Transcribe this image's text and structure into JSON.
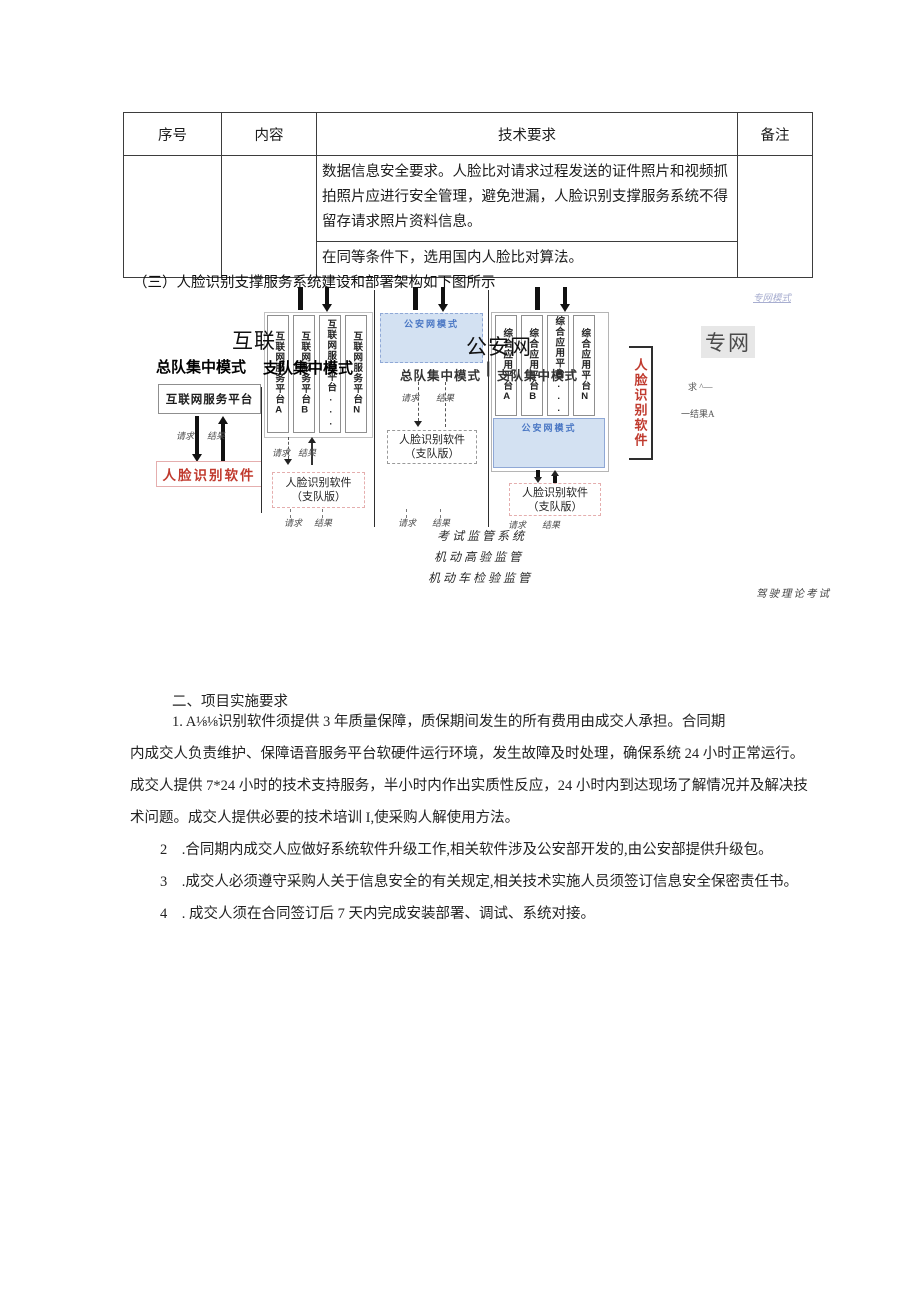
{
  "table": {
    "headers": [
      "序号",
      "内容",
      "技术要求",
      "备注"
    ],
    "row": {
      "seq": "",
      "content": "",
      "req1": "数据信息安全要求。人脸比对请求过程发送的证件照片和视频抓拍照片应进行安全管理，避免泄漏，人脸识别支撑服务系统不得留存请求照片资料信息。",
      "req2": "在同等条件下，选用国内人脸比对算法。",
      "note": ""
    }
  },
  "section_heading": "（三）人脸识别支撑服务系统建设和部署架构如下图所示",
  "diagram": {
    "labels": {
      "request": "请求",
      "result": "结果"
    },
    "overlay_internet": "互联",
    "overlay_public_net": "公安网",
    "overlay_private_net": "专网",
    "net_link": "专网模式",
    "fragment_request": "求 ^—",
    "fragment_result": "一结果A",
    "mode1": {
      "title": "总队集中模式",
      "platform": "互联网服务平台",
      "software": "人脸识别软件"
    },
    "mode2": {
      "title": "支队集中模式",
      "columns": [
        "互联网服务平台A",
        "互联网服务平台B",
        "互联网服务平台...",
        "互联网服务平台N"
      ],
      "software_line1": "人脸识别软件",
      "software_line2": "（支队版）"
    },
    "mode3": {
      "header": "公安网模式",
      "system_box": "考试监管系统",
      "exam_box": "驾驶理论考试",
      "overlay_left": "总队集中模式",
      "overlay_divider": "|",
      "overlay_right": "支队集中模式",
      "software_line1": "人脸识别软件",
      "software_line2": "（支队版）"
    },
    "mode4": {
      "header": "公安网模式",
      "columns": [
        "综合应用平台A",
        "综合应用平台B",
        "综合应用平台...",
        "综合应用平台N"
      ],
      "system_box": "考试监管软件",
      "exam_box": "驾驶理论考试",
      "software_line1": "人脸识别软件",
      "software_line2": "（支队版）"
    },
    "side_software_vertical": "人脸识别软件",
    "bottom_labels": [
      "考试监管系统",
      "机动高验监管",
      "机动车检验监管"
    ],
    "bottom_right_label": "驾驶理论考试"
  },
  "body": {
    "heading": "二、项目实施要求",
    "p1a": "1. A⅛⅛识别软件须提供 3 年质量保障，质保期间发生的所有费用由成交人承担。合同期",
    "p1b": "内成交人负责维护、保障语音服务平台软硬件运行环境，发生故障及时处理，确保系统 24 小时正常运行。",
    "p1c": "成交人提供 7*24 小时的技术支持服务，半小时内作出实质性反应，24 小时内到达现场了解情况并及解决技",
    "p1d": "术问题。成交人提供必要的技术培训 I,使采购人解使用方法。",
    "p2": "2　.合同期内成交人应做好系统软件升级工作,相关软件涉及公安部开发的,由公安部提供升级包。",
    "p3": "3　.成交人必须遵守采购人关于信息安全的有关规定,相关技术实施人员须签订信息安全保密责任书。",
    "p4": "4　. 成交人须在合同签订后 7 天内完成安装部署、调试、系统对接。"
  },
  "colors": {
    "red_accent": "#c03a2e",
    "pink_border": "#e5aeae",
    "blue_header_text": "#4a77c4",
    "blue_header_bg": "#d3e1f2",
    "link_text": "#a8aed0"
  }
}
